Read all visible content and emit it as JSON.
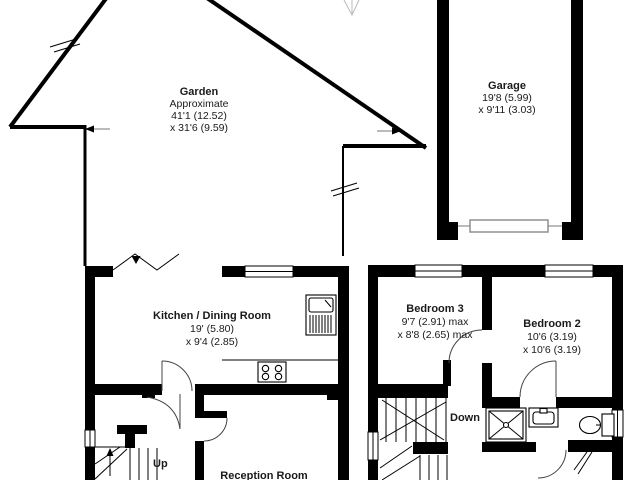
{
  "plan": {
    "garden": {
      "name": "Garden",
      "note": "Approximate",
      "dim1": "41'1 (12.52)",
      "dim2": "x 31'6 (9.59)"
    },
    "garage": {
      "name": "Garage",
      "dim1": "19'8 (5.99)",
      "dim2": "x 9'11 (3.03)"
    },
    "kitchen": {
      "name": "Kitchen / Dining Room",
      "dim1": "19' (5.80)",
      "dim2": "x 9'4 (2.85)"
    },
    "bedroom3": {
      "name": "Bedroom 3",
      "dim1": "9'7 (2.91) max",
      "dim2": "x 8'8 (2.65) max"
    },
    "bedroom2": {
      "name": "Bedroom 2",
      "dim1": "10'6 (3.19)",
      "dim2": "x 10'6 (3.19)"
    },
    "reception": {
      "name": "Reception Room"
    },
    "stairs": {
      "up": "Up",
      "down": "Down"
    },
    "colors": {
      "wall": "#000000",
      "background": "#ffffff",
      "fixture_gray": "#888888"
    }
  }
}
